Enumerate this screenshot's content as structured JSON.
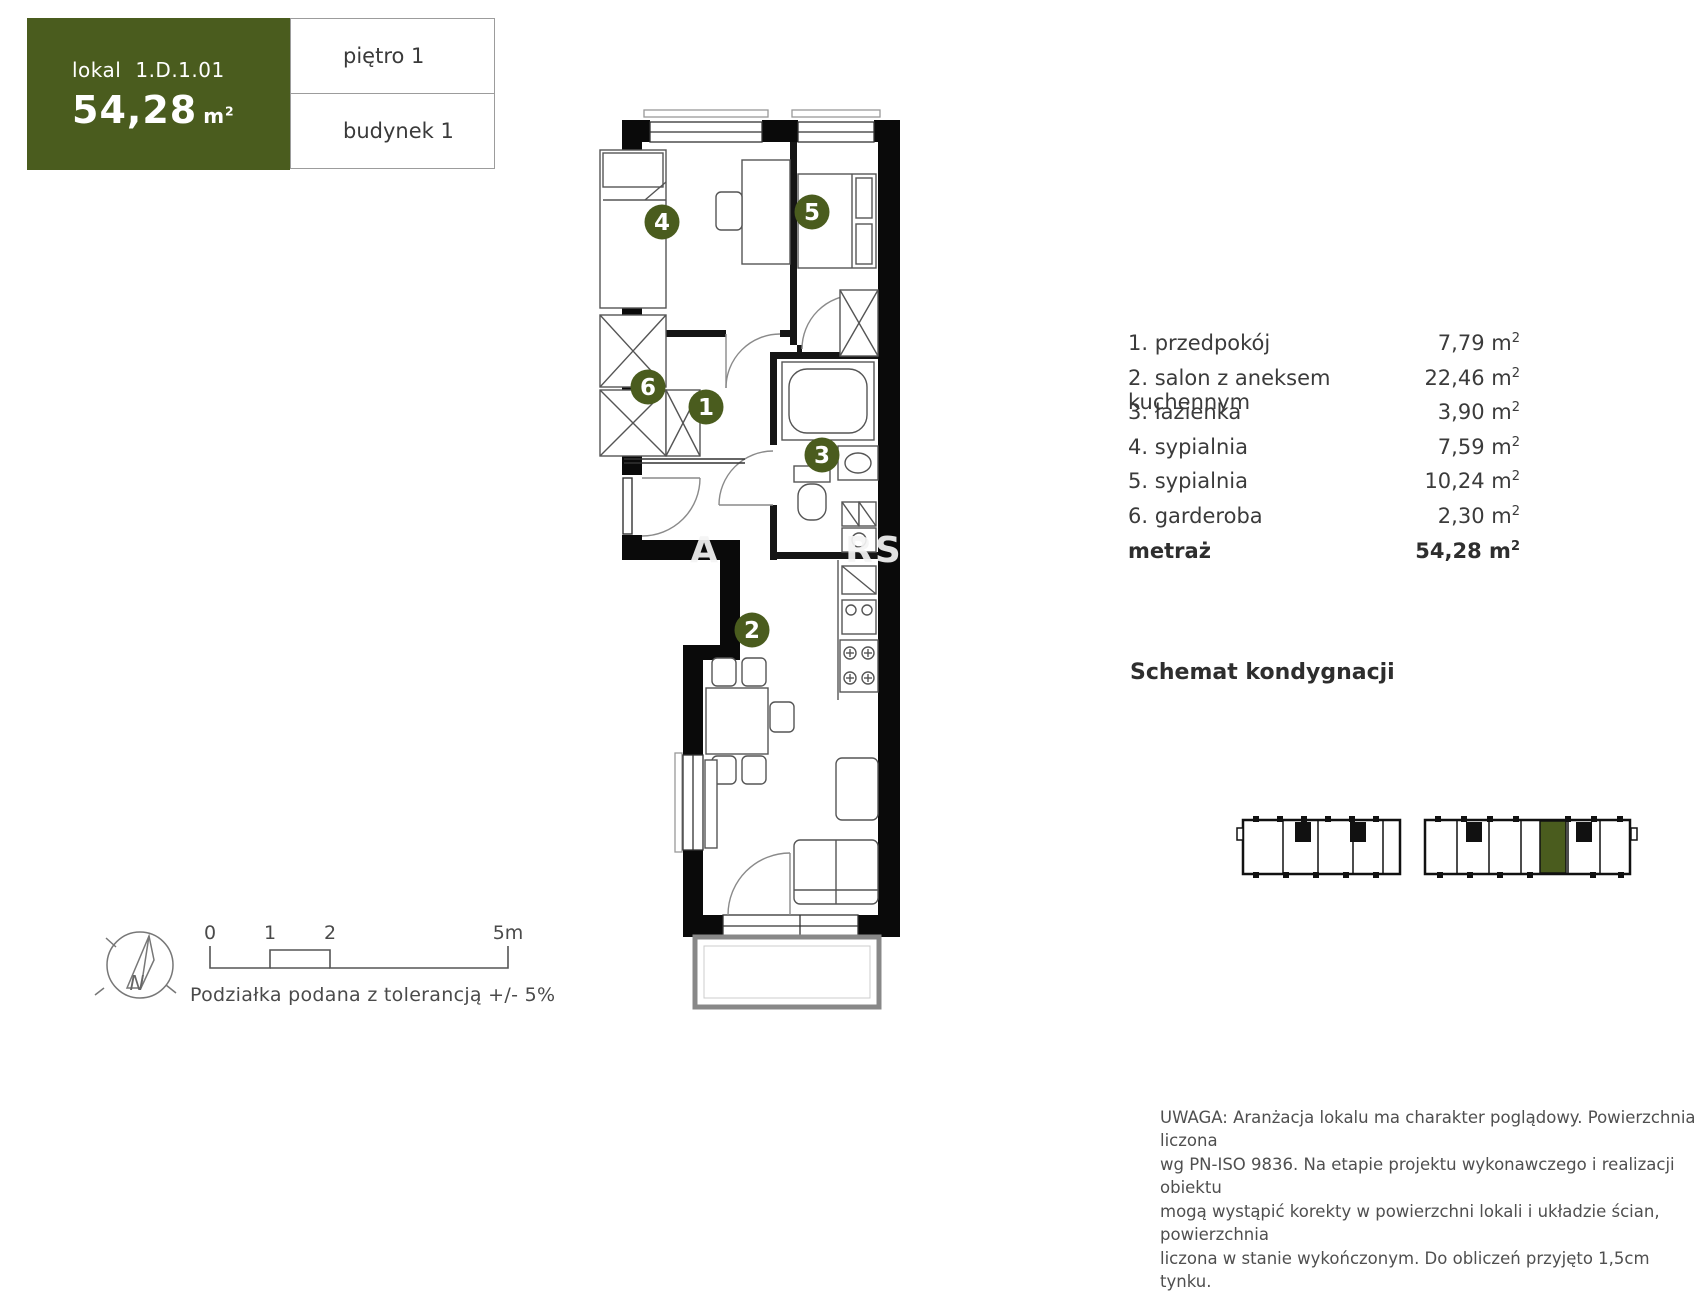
{
  "colors": {
    "accent": "#4a5c1e",
    "wall": "#0a0a0a",
    "furniture": "#555555"
  },
  "units": {
    "base": "m",
    "sup": "2"
  },
  "header": {
    "lokal_label": "lokal",
    "lokal_value": "1.D.1.01",
    "area_value": "54,28",
    "floor": "piętro 1",
    "building": "budynek 1"
  },
  "rooms": [
    {
      "num": "1",
      "name": "1. przedpokój",
      "area": "7,79"
    },
    {
      "num": "2",
      "name": "2. salon z aneksem kuchennym",
      "area": "22,46"
    },
    {
      "num": "3",
      "name": "3. łazienka",
      "area": "3,90"
    },
    {
      "num": "4",
      "name": "4. sypialnia",
      "area": "7,59"
    },
    {
      "num": "5",
      "name": "5. sypialnia",
      "area": "10,24"
    },
    {
      "num": "6",
      "name": "6. garderoba",
      "area": "2,30"
    }
  ],
  "total": {
    "label": "metraż",
    "area": "54,28"
  },
  "schemat": {
    "title": "Schemat kondygnacji"
  },
  "scalebar": {
    "tick0": "0",
    "tick1": "1",
    "tick2": "2",
    "tick5": "5m",
    "caption": "Podziałka podana z tolerancją +/- 5%"
  },
  "compass": {
    "north": "N"
  },
  "watermark": {
    "part1": "A",
    "part2": "RS"
  },
  "disclaimer": {
    "line1": "UWAGA: Aranżacja lokalu ma charakter poglądowy. Powierzchnia liczona",
    "line2": "wg PN-ISO 9836. Na etapie projektu wykonawczego i realizacji obiektu",
    "line3": "mogą wystąpić korekty w powierzchni lokali i układzie ścian, powierzchnia",
    "line4": "liczona w stanie wykończonym. Do obliczeń przyjęto 1,5cm tynku."
  }
}
